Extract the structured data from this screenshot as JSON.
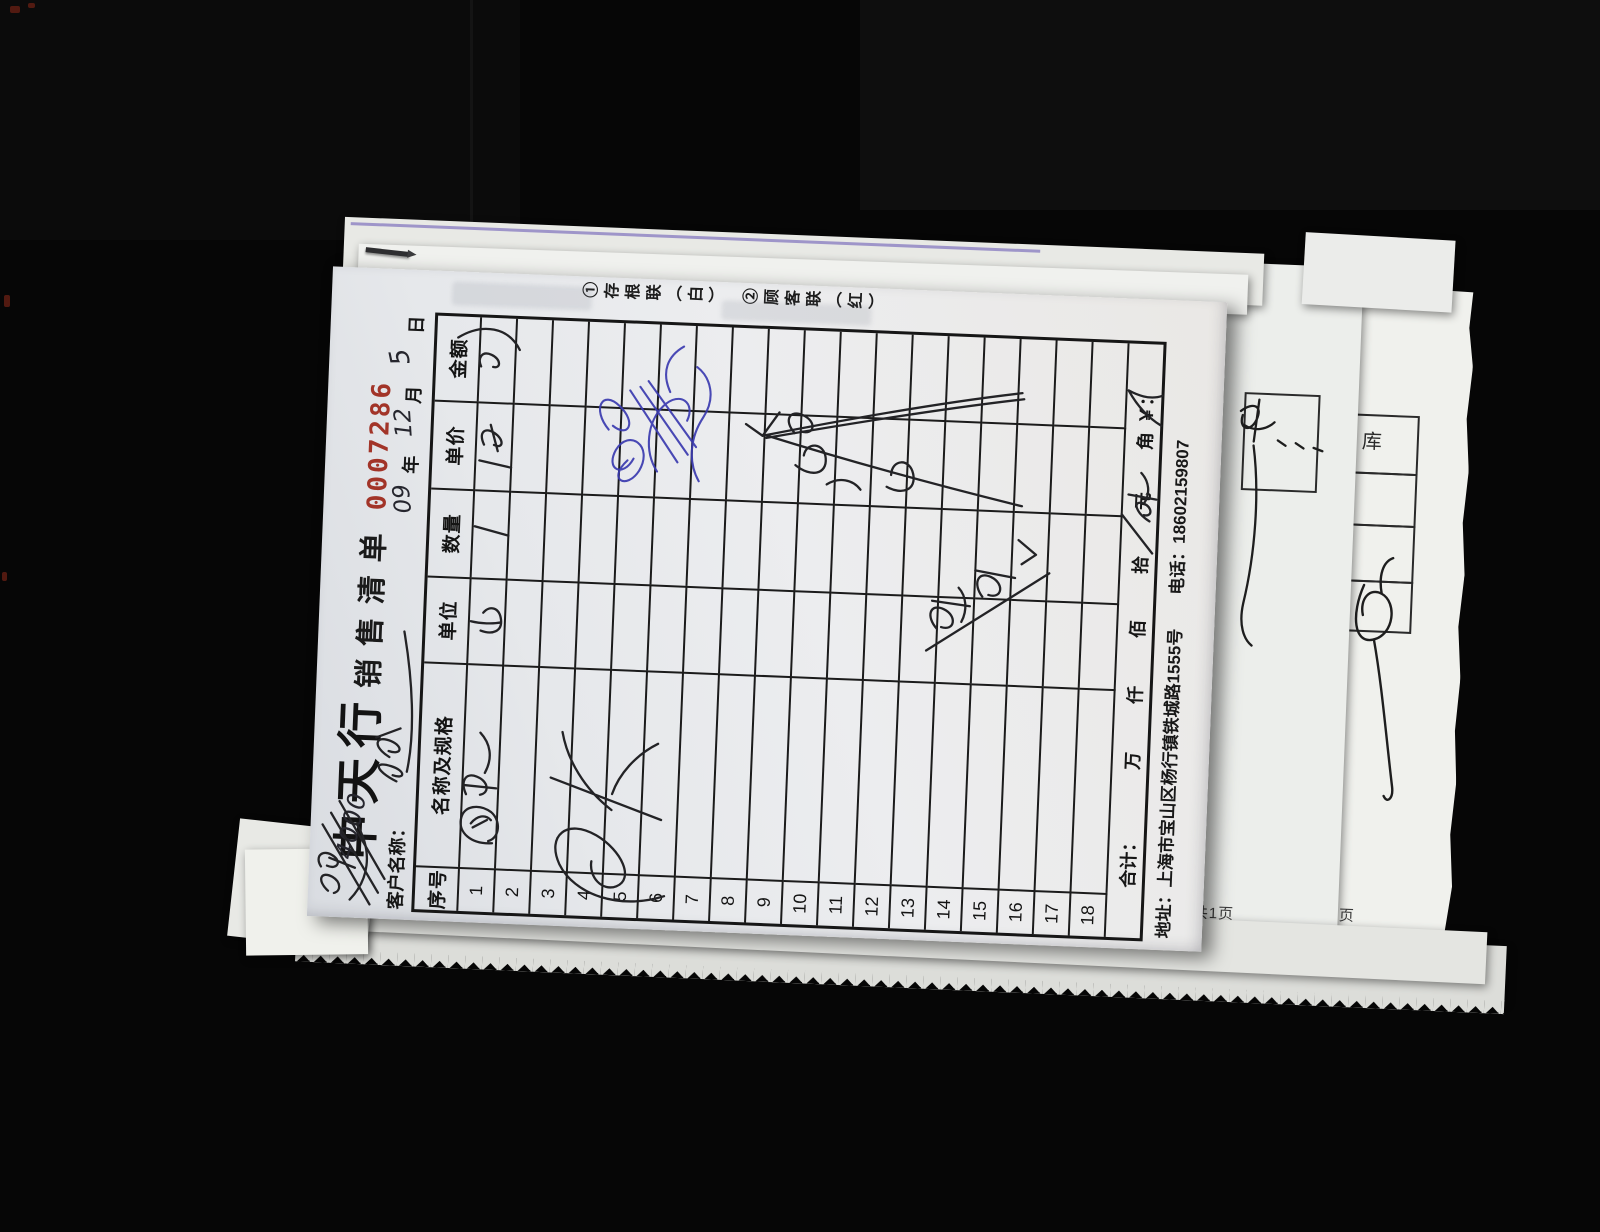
{
  "scene": {
    "background_color": "#060606",
    "paper_tilt_deg": 2.3
  },
  "document": {
    "title": "中天行",
    "subtitle": "销售清单",
    "serial_number": "0007286",
    "serial_color": "#a23428",
    "copy_notice": "①存根联（白）　②顾客联（红）",
    "customer_label": "客户名称：",
    "date": {
      "year_label": "年",
      "month_label": "月",
      "day_label": "日"
    },
    "handwritten": {
      "note": "4000",
      "year": "09",
      "month": "12",
      "day": "5"
    },
    "ink_colors": {
      "black_pen": "#232326",
      "blue_pen": "#3b3bb0"
    },
    "table": {
      "headers": [
        "序号",
        "名称及规格",
        "单位",
        "数量",
        "单价",
        "金额"
      ],
      "row_numbers": [
        "1",
        "2",
        "3",
        "4",
        "5",
        "6",
        "7",
        "8",
        "9",
        "10",
        "11",
        "12",
        "13",
        "14",
        "15",
        "16",
        "17",
        "18"
      ],
      "footer": {
        "total_label": "合计：",
        "units": [
          "万",
          "仟",
          "佰",
          "拾",
          "元",
          "角"
        ],
        "currency_symbol": "￥："
      }
    },
    "footer_line": {
      "address": "地址：上海市宝山区杨行镇铁城路1555号",
      "phone": "电话：18602159807"
    }
  },
  "underlying_pages": {
    "page_count_text": "共1页",
    "page_char": "页",
    "warehouse_char": "库"
  }
}
